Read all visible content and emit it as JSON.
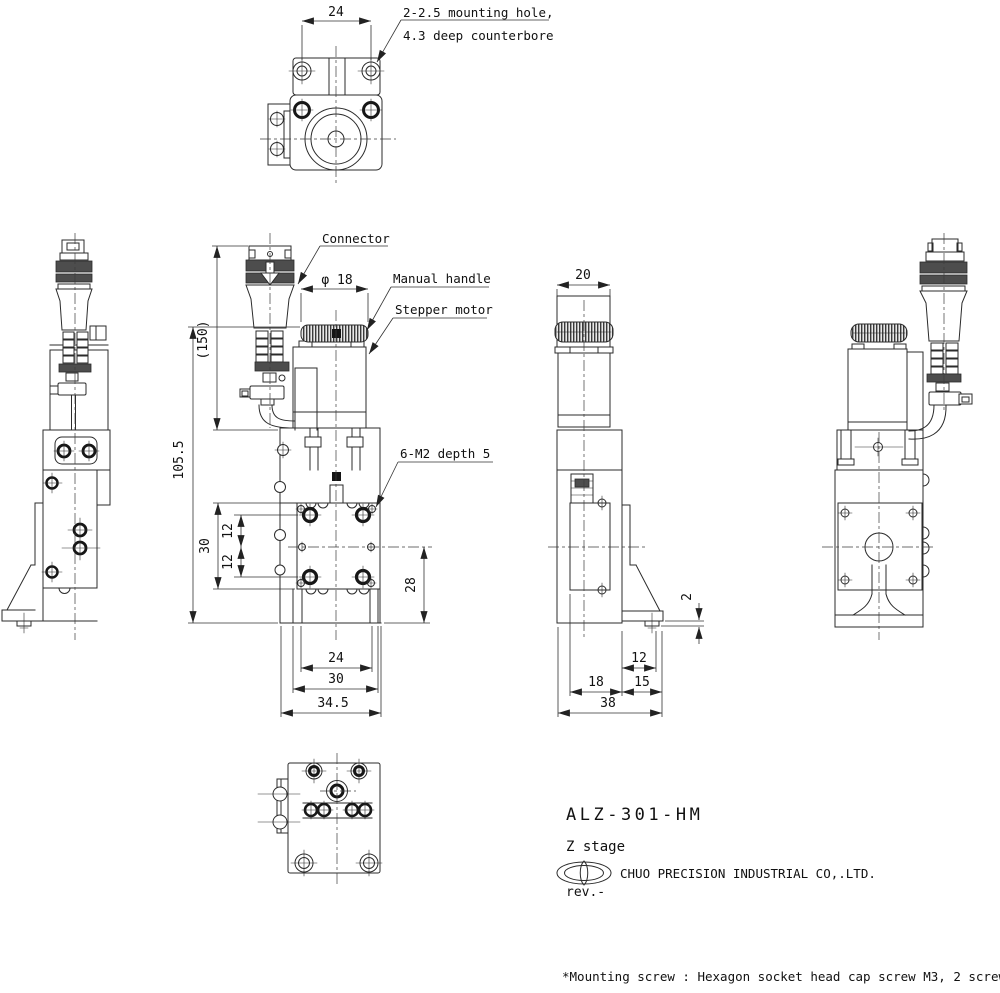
{
  "drawing": {
    "top_view": {
      "dim_hole_pitch": "24",
      "callout_line1": "2-2.5 mounting hole,",
      "callout_line2": "4.3 deep counterbore"
    },
    "front_view": {
      "label_connector": "Connector",
      "label_manual_handle": "Manual handle",
      "label_stepper_motor": "Stepper motor",
      "label_tapped_holes": "6-M2 depth 5",
      "dim_handle_dia": "φ 18",
      "dim_connector_height": "(150)",
      "dim_overall_height": "105.5",
      "dim_table_size": "30",
      "dim_hole_pitch_upper": "12",
      "dim_hole_pitch_lower": "12",
      "dim_center_height": "28",
      "dim_hole_pitch_h": "24",
      "dim_table_width": "30",
      "dim_base_width": "34.5"
    },
    "side_view": {
      "dim_handle_width": "20",
      "dim_base_plate_thickness": "2",
      "dim_foot_hole": "12",
      "dim_body_depth": "18",
      "dim_foot_depth": "15",
      "dim_overall_depth": "38"
    },
    "title_block": {
      "model": "ALZ-301-HM",
      "product_type": "Z stage",
      "company": "CHUO PRECISION INDUSTRIAL CO,.LTD.",
      "revision": "rev.-"
    },
    "footnote": "*Mounting screw : Hexagon socket head cap screw M3, 2 screws"
  }
}
